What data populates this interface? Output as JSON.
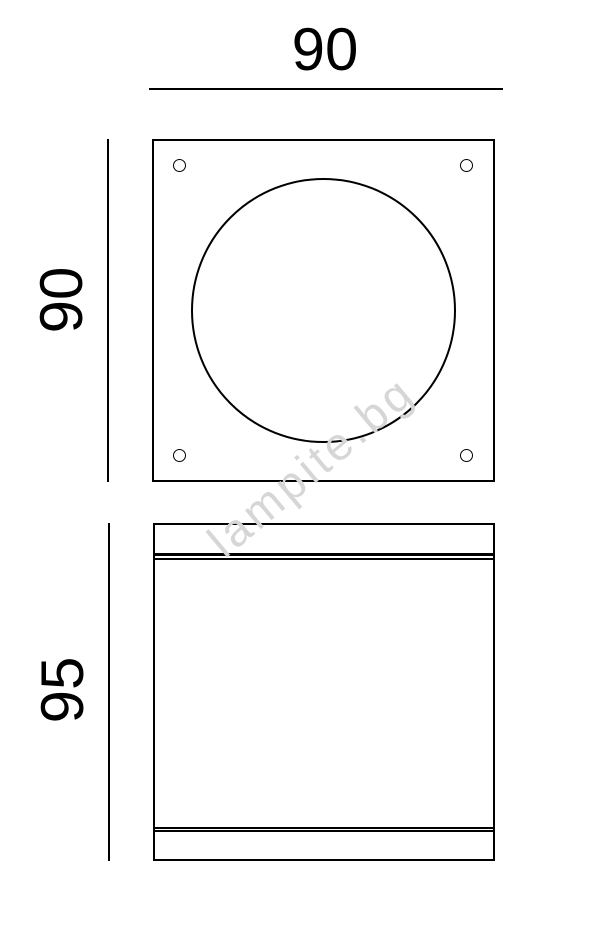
{
  "drawing": {
    "type": "technical-dimension-drawing",
    "views": {
      "top_view": {
        "width_dimension": "90",
        "height_dimension": "90",
        "features": [
          "square-faceplate",
          "inscribed-circle-diffuser",
          "four-corner-screw-holes"
        ]
      },
      "front_view": {
        "height_dimension": "95",
        "features": [
          "top-flange-band",
          "body",
          "bottom-flange-band"
        ]
      }
    },
    "colors": {
      "line": "#000000",
      "background": "#ffffff",
      "watermark": "#d6d6d6"
    }
  },
  "watermark": {
    "text": "lampite.bg"
  }
}
